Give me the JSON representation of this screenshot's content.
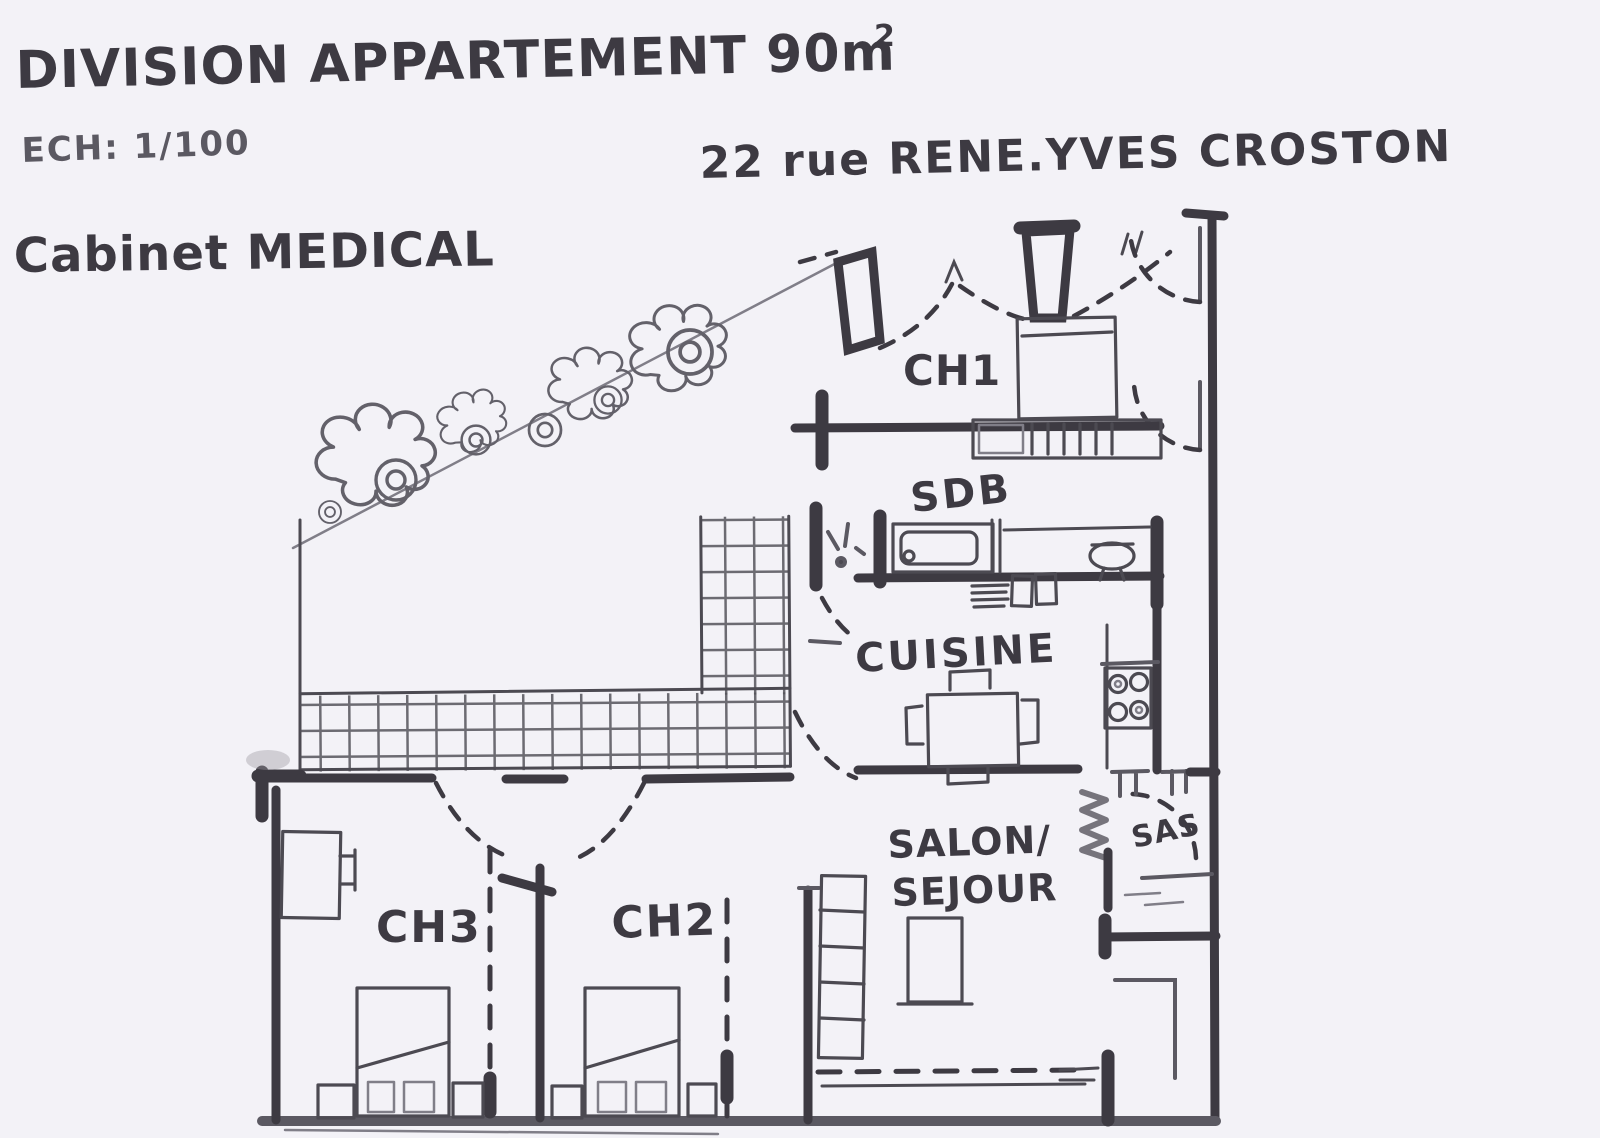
{
  "document": {
    "title_main": "DIVISION APPARTEMENT 90m",
    "title_superscript": "2",
    "scale_label": "ECH: 1/100",
    "project_type": "Cabinet MEDICAL",
    "address": "22 rue RENE.YVES CROSTON"
  },
  "plan": {
    "rooms": [
      {
        "id": "ch1",
        "label": "CH1",
        "type": "bedroom"
      },
      {
        "id": "sdb",
        "label": "SDB",
        "type": "bathroom"
      },
      {
        "id": "cuisine",
        "label": "CUISINE",
        "type": "kitchen"
      },
      {
        "id": "salon",
        "label": "SALON/",
        "label2": "SEJOUR",
        "type": "living-room"
      },
      {
        "id": "sas",
        "label": "SAS",
        "type": "vestibule"
      },
      {
        "id": "ch3",
        "label": "CH3",
        "type": "bedroom"
      },
      {
        "id": "ch2",
        "label": "CH2",
        "type": "bedroom"
      }
    ],
    "features": [
      "bed",
      "nightstand",
      "bathtub",
      "wc",
      "kitchen-sink",
      "stove-4-burners",
      "dining-table-with-chairs",
      "radiator",
      "bookshelf",
      "wardrobe",
      "door-swing-arcs",
      "tiled-terrace",
      "garden-bushes",
      "property-boundary-line",
      "attention-mark"
    ]
  },
  "colors": {
    "paper": "#f3f2f7",
    "ink": "#3d3a42",
    "ink_soft": "#5b5962",
    "pencil": "#807e88"
  }
}
